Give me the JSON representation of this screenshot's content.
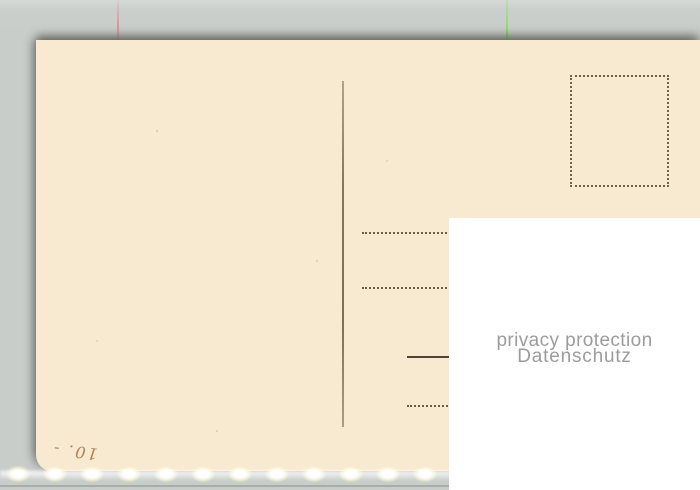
{
  "background": {
    "color": "#c9cdca"
  },
  "postcard": {
    "paper_color": "#f8e9d1",
    "ink_color": "#6b5c49",
    "divider_line_color": "#84765f",
    "handwriting": {
      "text": "10. -",
      "color": "#a4703a"
    }
  },
  "privacy_overlay": {
    "background_color": "#ffffff",
    "text_color": "#9c9c9c",
    "line1": "privacy protection",
    "line2": "Datenschutz"
  },
  "scan_artifacts": {
    "red_line_color": "#f0788c",
    "green_line_color": "#6ee646",
    "glow_color": "#ffffff"
  }
}
